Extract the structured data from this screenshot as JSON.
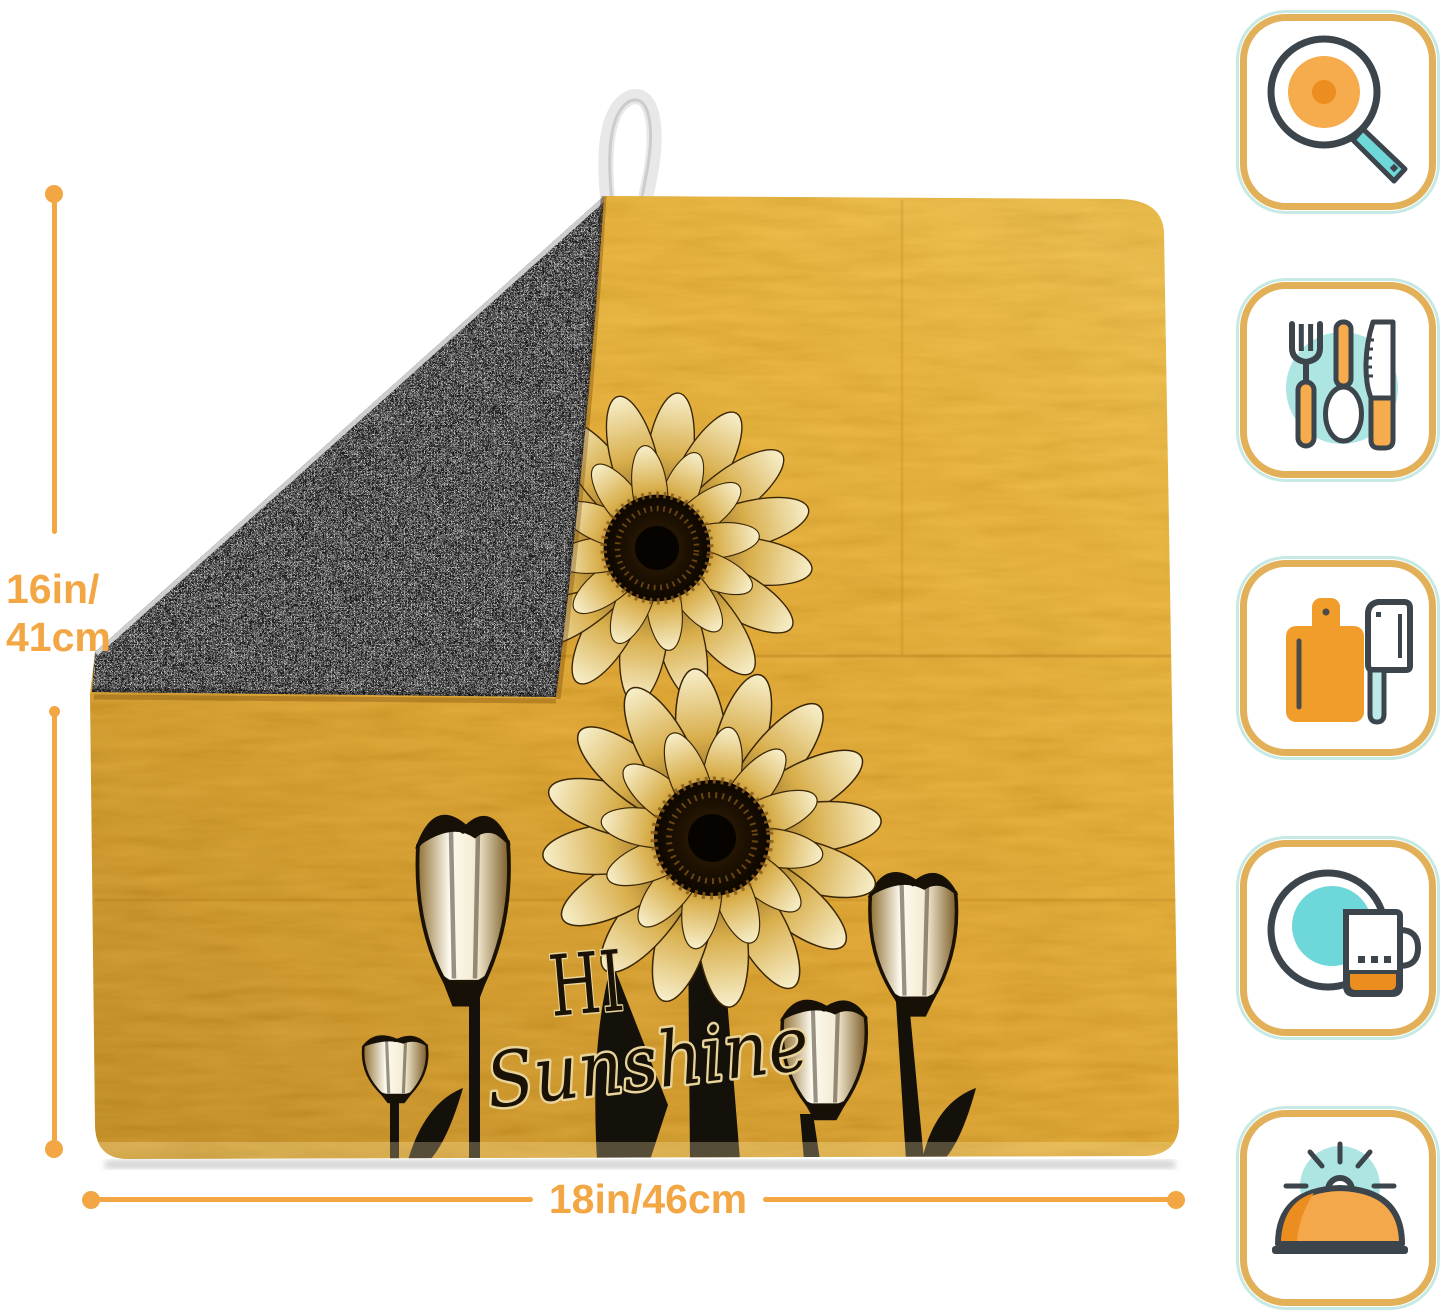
{
  "annotations": {
    "height_line1": "16in/",
    "height_line2": "41cm",
    "width_label": "18in/46cm"
  },
  "mat": {
    "text_hi": "HI",
    "text_sunshine": "Sunshine",
    "pattern": "golden sunflowers and tulip silhouettes on textured gold",
    "backing": "gray microfiber terry"
  },
  "icons": [
    {
      "name": "frying-pan-icon"
    },
    {
      "name": "utensils-icon"
    },
    {
      "name": "cutting-board-icon"
    },
    {
      "name": "dish-and-mug-icon"
    },
    {
      "name": "serving-dome-icon"
    }
  ],
  "colors": {
    "accent": "#F3A644",
    "tan": "#E3B05A",
    "mint": "#C6EAE3",
    "teal": "#6ED7D8",
    "teal_light": "#ACE5E2",
    "outline_dark": "#3C444C",
    "icon_orange": "#F6AC4D",
    "icon_orange_dark": "#EC8D1F",
    "mat_gold": "#E5A51D",
    "backing_gray": "#A9A9A9",
    "loop_white": "#E8E8E8"
  }
}
